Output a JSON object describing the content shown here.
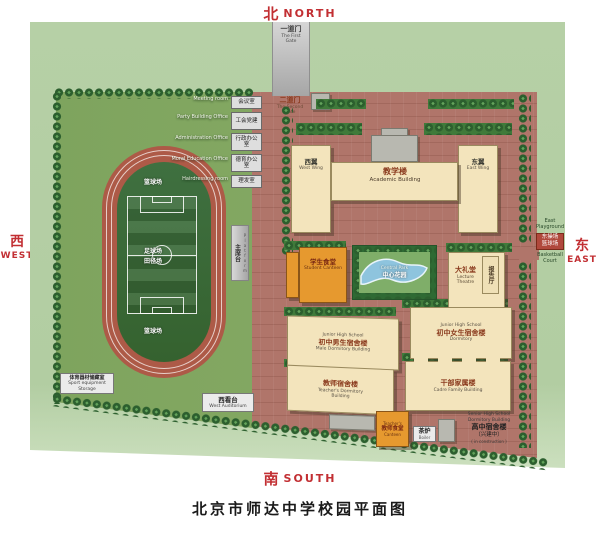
{
  "title": "北京市师达中学校园平面图",
  "compass": {
    "north_zh": "北",
    "north_en": "NORTH",
    "south_zh": "南",
    "south_en": "SOUTH",
    "west_zh": "西",
    "west_en": "WEST",
    "east_zh": "东",
    "east_en": "EAST"
  },
  "gates": {
    "first_zh": "一道门",
    "first_en": "The First Gate",
    "second_zh": "二道门",
    "second_en": "The Second Gate"
  },
  "offices": [
    {
      "en": "Meeting room",
      "zh": "会议室"
    },
    {
      "en": "Party Building Office",
      "zh": "工会党建"
    },
    {
      "en": "Administration Office",
      "zh": "行政办公室"
    },
    {
      "en": "Moral Education Office",
      "zh": "德育办公室"
    },
    {
      "en": "Hairdressing room",
      "zh": "理发室"
    }
  ],
  "field": {
    "north_court": "篮球场",
    "center_zh1": "足球场",
    "center_zh2": "田径场",
    "south_court": "篮球场",
    "platform_zh": "主席台",
    "platform_en": "Platform",
    "equipment_zh": "体育器材储藏室",
    "equipment_en1": "Sport equipment",
    "equipment_en2": "Storage",
    "west_stand_zh": "西看台",
    "west_stand_en": "West Auditorium"
  },
  "buildings": {
    "west_wing_zh": "西翼",
    "west_wing_en": "West Wing",
    "academic_zh": "教学楼",
    "academic_en": "Academic Building",
    "east_wing_zh": "东翼",
    "east_wing_en": "East Wing",
    "canteen_zh": "学生食堂",
    "canteen_en": "Student Canteen",
    "garden_en": "Central Park",
    "garden_zh": "中心花园",
    "theatre_zh": "大礼堂",
    "theatre_en": "Lecture Theatre",
    "theatre_annex": "报告厅",
    "male_dorm_en1": "Junior High School",
    "male_dorm_zh": "初中男生宿舍楼",
    "male_dorm_en2": "Male Dormitory Building",
    "female_dorm_en1": "Junior High School",
    "female_dorm_zh": "初中女生宿舍楼",
    "female_dorm_en2": "Dormitory",
    "teacher_dorm_zh": "教师宿舍楼",
    "teacher_dorm_en1": "Teacher's Dormitory",
    "teacher_dorm_en2": "Building",
    "cadre_zh": "干部家属楼",
    "cadre_en": "Cadre Family Building",
    "teacher_canteen_en1": "Teacher's",
    "teacher_canteen_zh": "教师食堂",
    "teacher_canteen_en2": "Canteen",
    "boiler_zh": "茶炉",
    "boiler_en": "Boiler",
    "senior_en1": "Senior High School",
    "senior_en2": "Dormitory Building",
    "senior_zh": "高中宿舍楼",
    "senior_zh2": "（兴建中）",
    "senior_en3": "( in construction )"
  },
  "east_strip": {
    "en1": "East Playground",
    "zh1": "东操场",
    "zh2": "篮球场",
    "en2": "Basketball Court"
  },
  "colors": {
    "compass_red": "#c22f33",
    "campus_ground": "#b0756a",
    "grass": "#83a562",
    "track": "#ad5a47",
    "building_cream": "#f3e4bc",
    "building_orange": "#e6992f",
    "panel_green": "#b6d0a6"
  }
}
